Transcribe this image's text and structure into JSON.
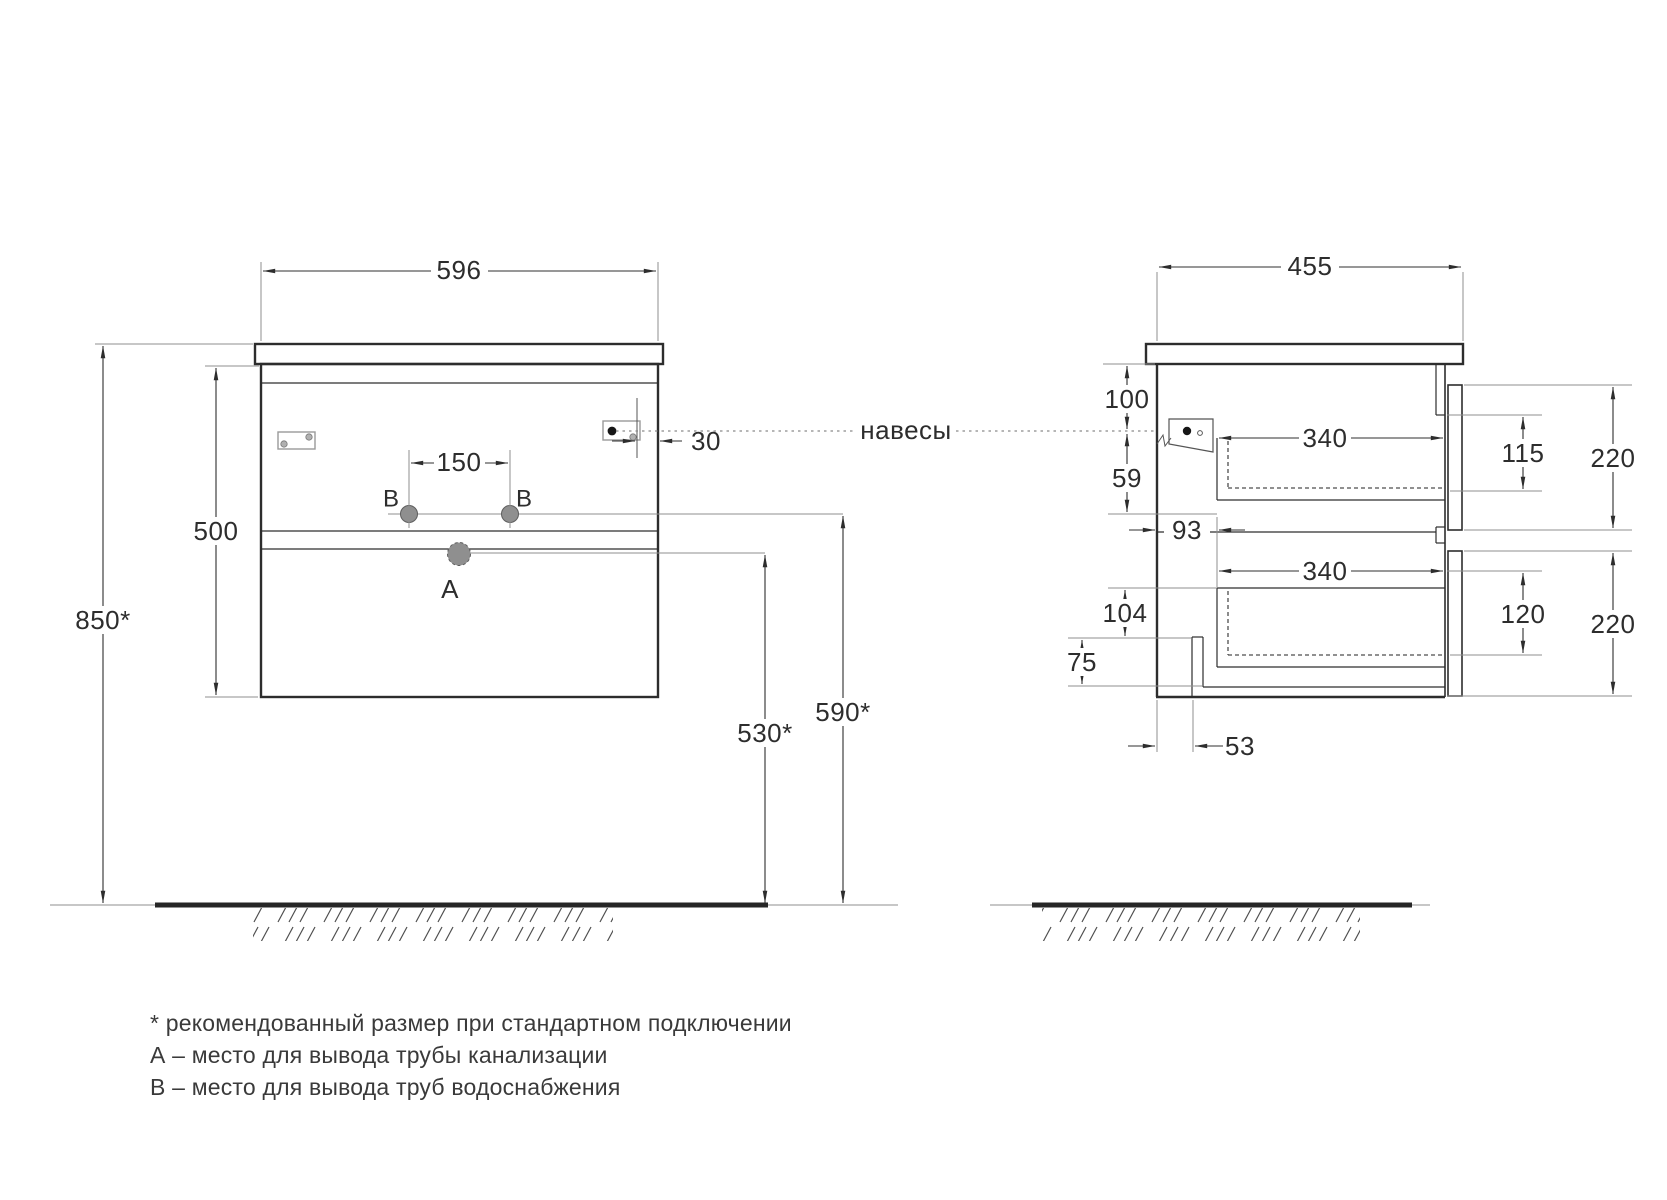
{
  "drawing_title": "bathroom-vanity-installation-drawing",
  "colors": {
    "line": "#2d2d2d",
    "secondary_gray": "#8f8f8f",
    "hole_fill": "#8f8f8f",
    "floor": "#262626",
    "background": "#ffffff"
  },
  "front": {
    "width": "596",
    "height": "500",
    "mounting_height": "850*",
    "water_spacing": "150",
    "hanger_offset": "30",
    "drain_height": "530*",
    "water_height": "590*",
    "drain_label": "A",
    "water_label": "B"
  },
  "side": {
    "depth": "455",
    "hanger_top_offset": "100",
    "hanger_drop": "59",
    "back_clearance": "93",
    "upper_drawer_depth": "340",
    "upper_drawer_inner_height": "115",
    "upper_front_height": "220",
    "lower_drawer_depth": "340",
    "lower_drawer_inner_height": "120",
    "lower_front_height": "220",
    "bottom_offset": "104",
    "bottom_edge": "75",
    "notch_width": "53"
  },
  "hangers_label": "навесы",
  "notes": [
    "* рекомендованный размер при стандартном подключении",
    "А – место для вывода трубы канализации",
    "В – место для вывода труб водоснабжения"
  ]
}
